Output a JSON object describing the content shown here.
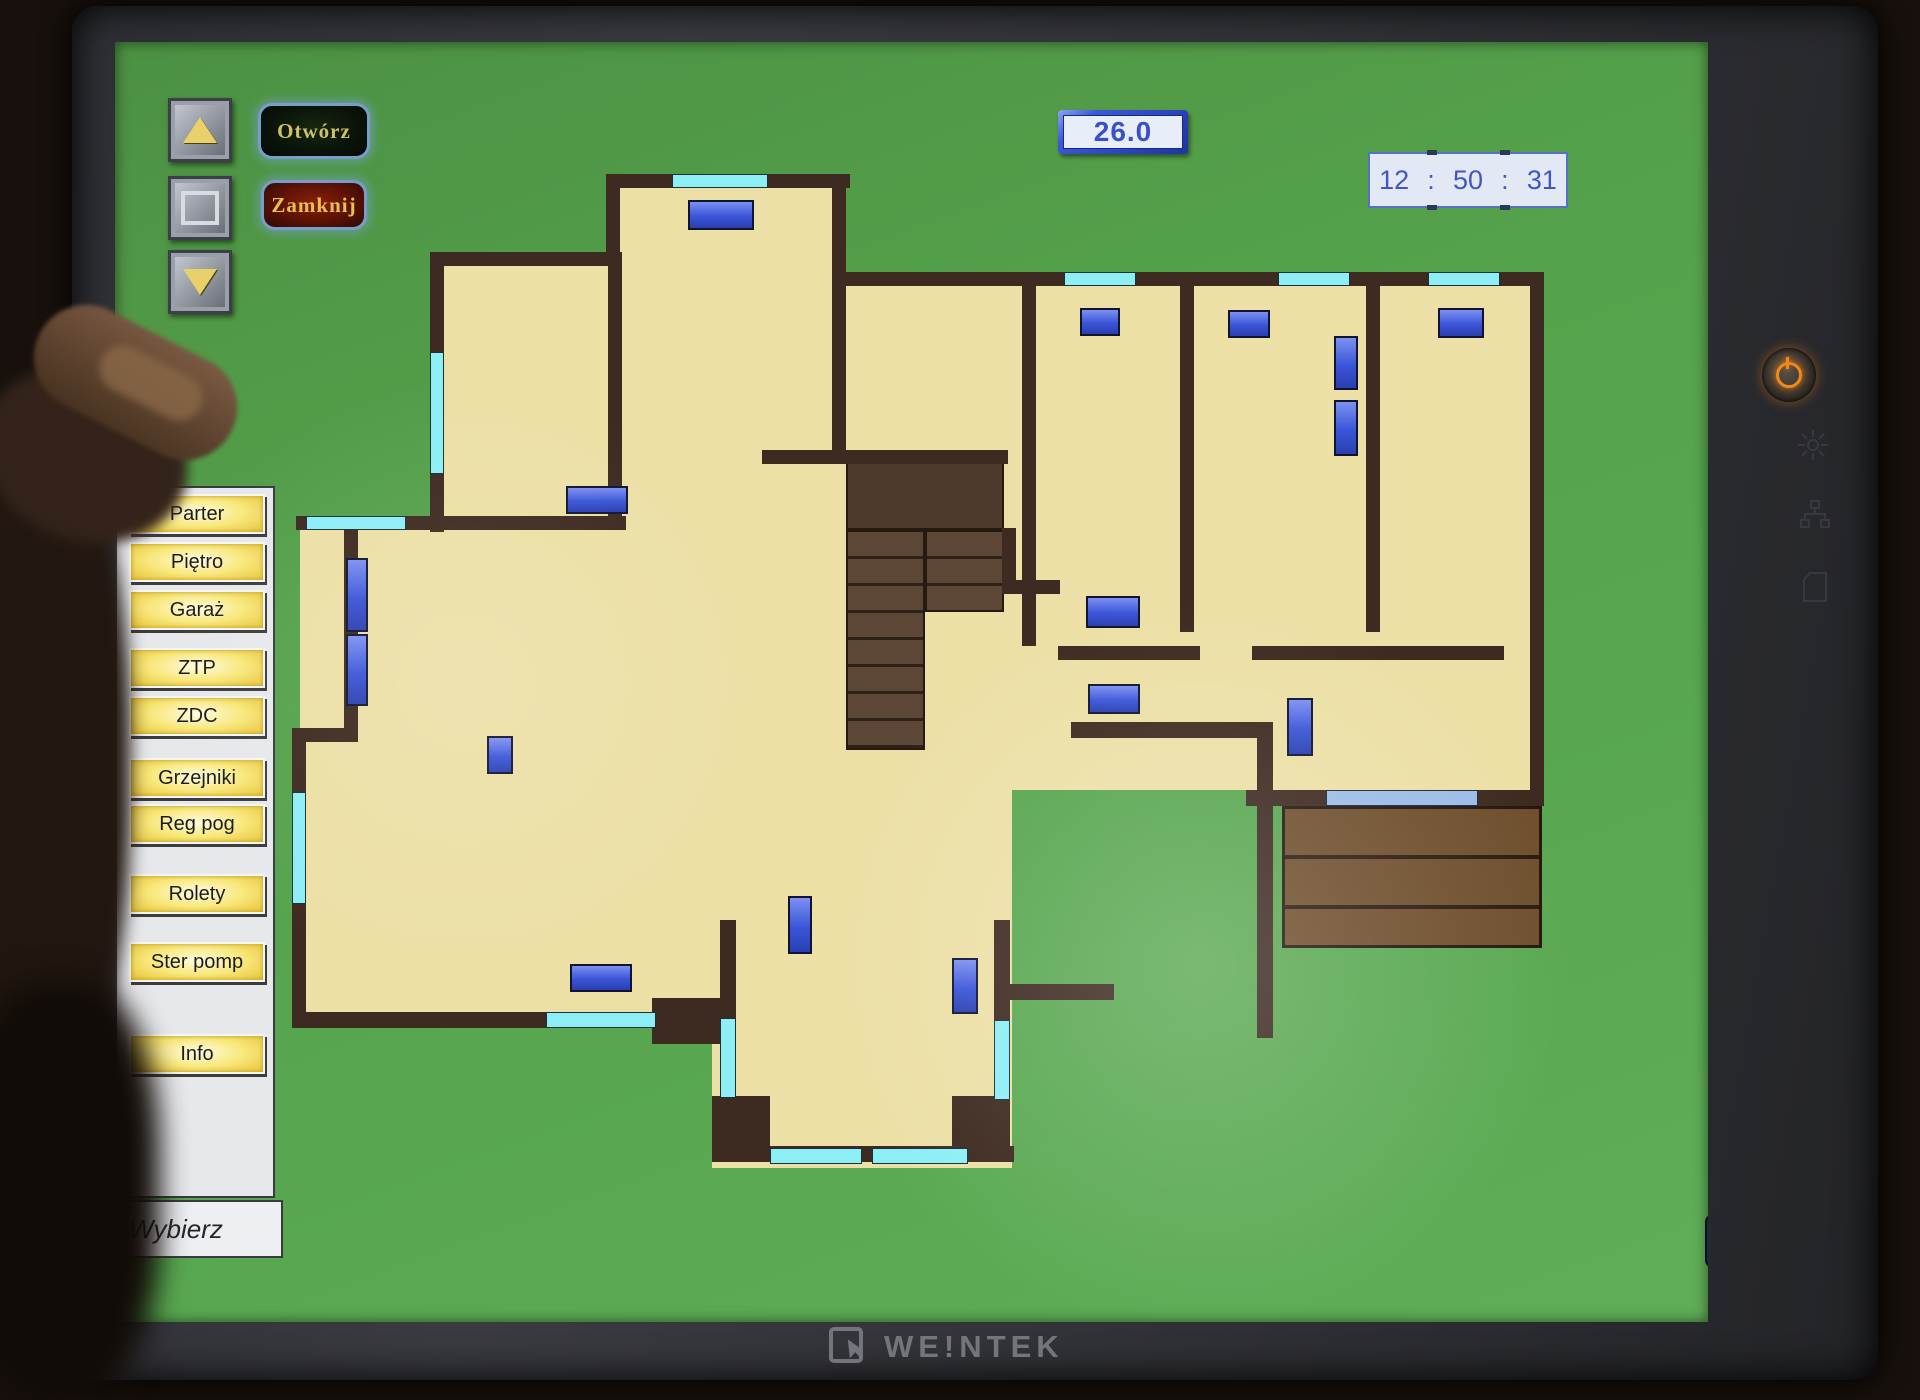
{
  "device": {
    "brand": "WE!NTEK",
    "hardware": {
      "power_button": "power",
      "bezel_icons": [
        "brightness",
        "network",
        "sd-card"
      ]
    }
  },
  "colors": {
    "screen_green": "#55a14b",
    "floor_tan": "#ece0a6",
    "wall_brown": "#3d2a20",
    "window_cyan": "#8deef5",
    "radiator_blue": "#3a55d8",
    "display_blue": "#3a50c8",
    "setpoint_red": "#c23b28",
    "button_yellow": "#f8e87c"
  },
  "top_bar": {
    "outside_temp": "26.0",
    "open_label": "Otwórz",
    "close_label": "Zamknij",
    "clock": {
      "hours": "12",
      "minutes": "50",
      "seconds": "31",
      "separator": ":"
    }
  },
  "sidebar": {
    "buttons": [
      {
        "label": "Parter",
        "y": 492
      },
      {
        "label": "Piętro",
        "y": 540
      },
      {
        "label": "Garaż",
        "y": 588
      },
      {
        "label": "ZTP",
        "y": 646
      },
      {
        "label": "ZDC",
        "y": 694
      },
      {
        "label": "Grzejniki",
        "y": 756
      },
      {
        "label": "Reg pog",
        "y": 802
      },
      {
        "label": "Rolety",
        "y": 872
      },
      {
        "label": "Ster pomp",
        "y": 940
      },
      {
        "label": "Info",
        "y": 1032
      }
    ],
    "footer": "Wybierz"
  },
  "back_button": {
    "glyph": "←"
  },
  "rooms": [
    {
      "name": "room-1",
      "temp": "24.5",
      "setpoint": "26.0",
      "x": 558,
      "y": 336,
      "w": 100,
      "h": 42
    },
    {
      "name": "room-2",
      "temp": "24.0",
      "setpoint": "26.0",
      "x": 832,
      "y": 336,
      "w": 100,
      "h": 42
    },
    {
      "name": "room-3",
      "temp": "23.8",
      "setpoint": "26.0",
      "x": 1040,
      "y": 480,
      "w": 100,
      "h": 42
    },
    {
      "name": "room-4",
      "temp": "23.5",
      "setpoint": "26.0",
      "x": 1205,
      "y": 482,
      "w": 100,
      "h": 42
    },
    {
      "name": "room-5",
      "temp": "25.5",
      "setpoint": "20.0",
      "x": 1380,
      "y": 480,
      "w": 104,
      "h": 42
    },
    {
      "name": "room-6",
      "temp": "24.3",
      "setpoint": "25.0",
      "x": 1038,
      "y": 642,
      "w": 104,
      "h": 44
    },
    {
      "name": "room-7",
      "temp": "24.1",
      "setpoint": "23.0",
      "x": 1380,
      "y": 644,
      "w": 102,
      "h": 44
    },
    {
      "name": "room-8",
      "temp": "25.0",
      "setpoint": "27.0",
      "x": 545,
      "y": 816,
      "w": 100,
      "h": 42
    },
    {
      "name": "room-9",
      "temp": "25.0",
      "setpoint": "27.0",
      "x": 814,
      "y": 972,
      "w": 102,
      "h": 44
    }
  ],
  "plan": {
    "floors": [
      [
        430,
        252,
        190,
        280
      ],
      [
        606,
        174,
        240,
        292
      ],
      [
        836,
        272,
        708,
        372
      ],
      [
        300,
        516,
        456,
        512
      ],
      [
        606,
        450,
        706,
        340
      ],
      [
        1296,
        568,
        248,
        236
      ],
      [
        712,
        760,
        300,
        408
      ],
      [
        292,
        728,
        122,
        300
      ]
    ],
    "walls": [
      [
        430,
        252,
        192,
        14
      ],
      [
        430,
        252,
        14,
        280
      ],
      [
        296,
        516,
        330,
        14
      ],
      [
        606,
        174,
        244,
        14
      ],
      [
        606,
        174,
        14,
        92
      ],
      [
        608,
        252,
        14,
        266
      ],
      [
        832,
        174,
        14,
        290
      ],
      [
        762,
        450,
        246,
        14
      ],
      [
        836,
        272,
        708,
        14
      ],
      [
        1530,
        272,
        14,
        374
      ],
      [
        1530,
        646,
        14,
        152
      ],
      [
        1022,
        286,
        14,
        360
      ],
      [
        1180,
        286,
        14,
        346
      ],
      [
        1366,
        286,
        14,
        346
      ],
      [
        1058,
        646,
        142,
        14
      ],
      [
        1252,
        646,
        252,
        14
      ],
      [
        1002,
        528,
        14,
        66
      ],
      [
        1002,
        580,
        58,
        14
      ],
      [
        1071,
        722,
        202,
        16
      ],
      [
        1257,
        738,
        16,
        300
      ],
      [
        1246,
        790,
        84,
        16
      ],
      [
        1478,
        790,
        66,
        16
      ],
      [
        344,
        516,
        14,
        214
      ],
      [
        292,
        728,
        66,
        14
      ],
      [
        292,
        728,
        14,
        300
      ],
      [
        292,
        1012,
        256,
        16
      ],
      [
        652,
        998,
        72,
        46
      ],
      [
        720,
        920,
        16,
        100
      ],
      [
        712,
        1096,
        58,
        58
      ],
      [
        712,
        1146,
        302,
        16
      ],
      [
        952,
        1096,
        58,
        58
      ],
      [
        994,
        920,
        16,
        102
      ],
      [
        1008,
        984,
        106,
        16
      ]
    ],
    "windows": [
      [
        672,
        174,
        96,
        14
      ],
      [
        430,
        352,
        14,
        122
      ],
      [
        306,
        516,
        100,
        14
      ],
      [
        1064,
        272,
        72,
        14
      ],
      [
        1278,
        272,
        72,
        14
      ],
      [
        1428,
        272,
        72,
        14
      ],
      [
        292,
        792,
        14,
        112
      ],
      [
        546,
        1012,
        110,
        16
      ],
      [
        720,
        1018,
        16,
        80
      ],
      [
        770,
        1148,
        92,
        16
      ],
      [
        872,
        1148,
        96,
        16
      ],
      [
        994,
        1020,
        16,
        80
      ]
    ],
    "radiators": [
      [
        688,
        200,
        66,
        30
      ],
      [
        566,
        486,
        62,
        28
      ],
      [
        1080,
        308,
        40,
        28
      ],
      [
        1228,
        310,
        42,
        28
      ],
      [
        1438,
        308,
        46,
        30
      ],
      [
        1334,
        336,
        24,
        54
      ],
      [
        1334,
        400,
        24,
        56
      ],
      [
        1086,
        596,
        54,
        32
      ],
      [
        1088,
        684,
        52,
        30
      ],
      [
        1287,
        698,
        26,
        58
      ],
      [
        346,
        558,
        22,
        74
      ],
      [
        346,
        634,
        22,
        72
      ],
      [
        487,
        736,
        26,
        38
      ],
      [
        570,
        964,
        62,
        28
      ],
      [
        952,
        958,
        26,
        56
      ],
      [
        788,
        896,
        24,
        58
      ]
    ],
    "terrace": [
      1282,
      806,
      260,
      142
    ],
    "sliding_door": [
      1326,
      790,
      152,
      16
    ],
    "stairs": {
      "landing": [
        846,
        462,
        158,
        68
      ],
      "left_flight": [
        846,
        530,
        79,
        220
      ],
      "right_flight": [
        925,
        530,
        79,
        82
      ]
    }
  }
}
